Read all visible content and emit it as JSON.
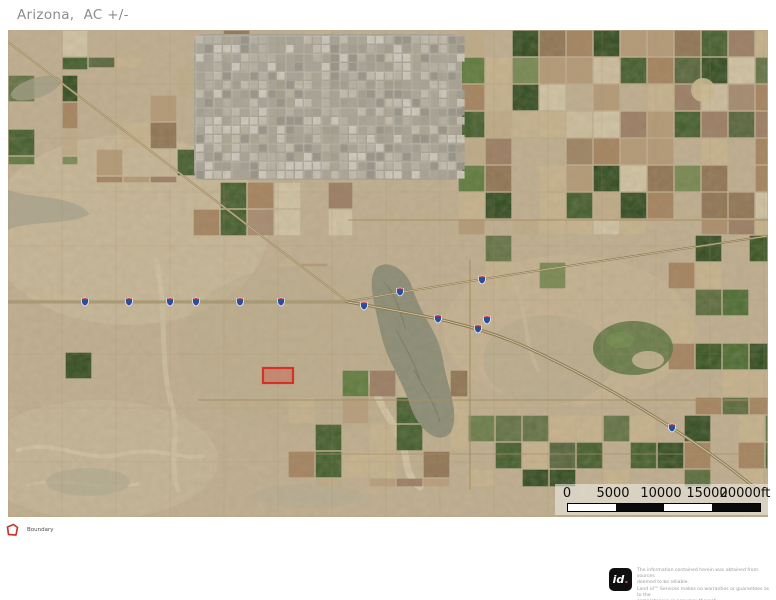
{
  "title": "Arizona,  AC +/-",
  "map": {
    "description": "satellite imagery of Casa Grande / Arizona City area with parcel boundary highlight",
    "scale_bar": {
      "labels": [
        "0",
        "5000",
        "10000",
        "15000",
        "20000ft"
      ]
    },
    "markers": {
      "interstate_shields": [
        {
          "x": 77,
          "y": 272
        },
        {
          "x": 121,
          "y": 272
        },
        {
          "x": 162,
          "y": 272
        },
        {
          "x": 188,
          "y": 272
        },
        {
          "x": 232,
          "y": 272
        },
        {
          "x": 273,
          "y": 272
        },
        {
          "x": 356,
          "y": 276
        },
        {
          "x": 392,
          "y": 262
        },
        {
          "x": 474,
          "y": 250
        },
        {
          "x": 430,
          "y": 289
        },
        {
          "x": 470,
          "y": 299
        },
        {
          "x": 479,
          "y": 290
        },
        {
          "x": 664,
          "y": 398
        }
      ]
    },
    "parcel": {
      "name": "boundary-parcel",
      "color": "#d63126",
      "x": 255,
      "y": 338,
      "w": 30,
      "h": 15
    }
  },
  "legend": {
    "items": [
      {
        "label": "Boundary",
        "color": "#c2392e"
      }
    ]
  },
  "disclaimer": {
    "logo_text": "id",
    "logo_dot": ".",
    "lines": [
      "The information contained herein was obtained from sources",
      "deemed to be reliable.",
      " Land id™ Services makes no warranties or guarantees as to the",
      "completeness or accuracy thereof."
    ]
  }
}
